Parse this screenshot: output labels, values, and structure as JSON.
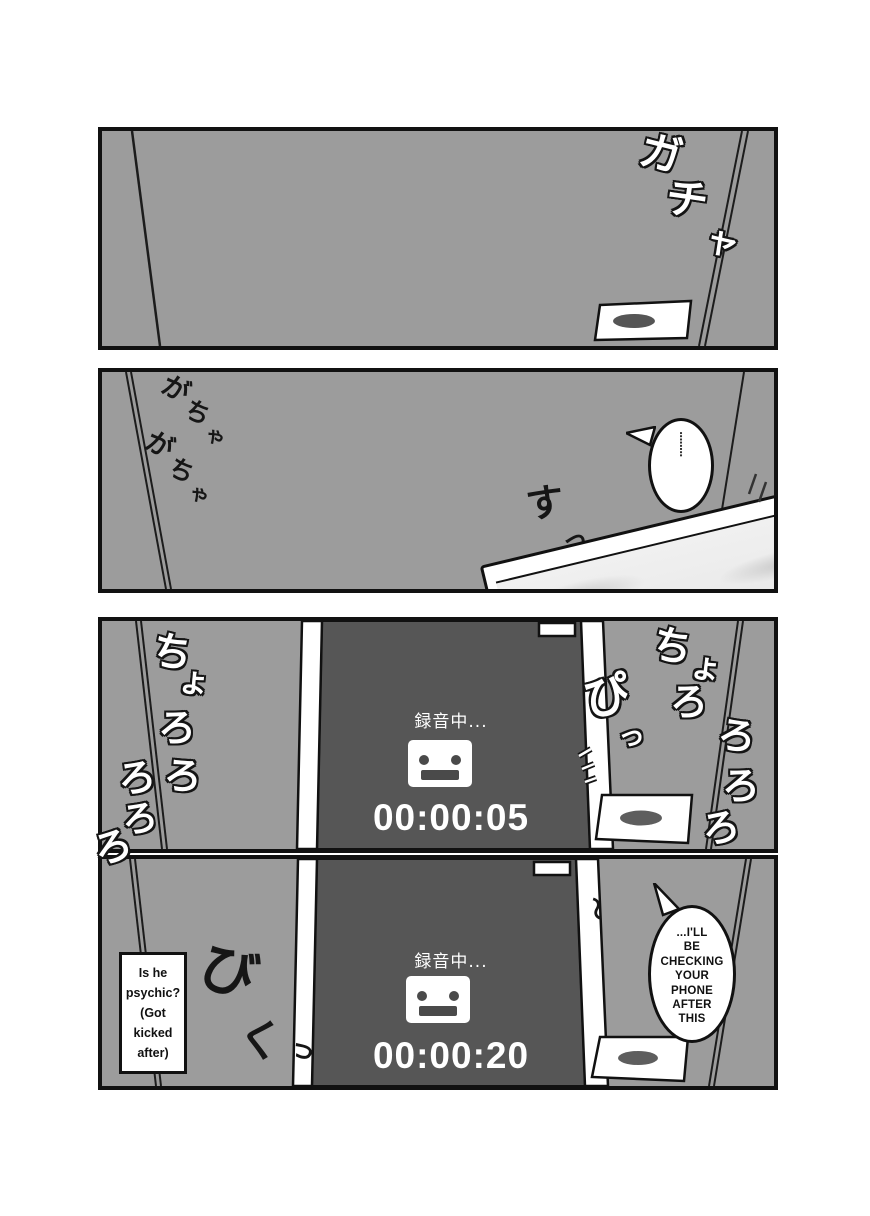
{
  "colors": {
    "wall": "#9c9c9c",
    "panel_border": "#111111",
    "screen": "#565656",
    "ink": "#161616",
    "light_oval": "#5e5e5e",
    "white": "#ffffff"
  },
  "panel1": {
    "sfx_door_open": {
      "chars": [
        "ガ",
        "チ",
        "ャ"
      ]
    }
  },
  "panel2": {
    "sfx_rattle_1": {
      "chars": [
        "が",
        "ち",
        "ゃ"
      ]
    },
    "sfx_rattle_2": {
      "chars": [
        "が",
        "ち",
        "ゃ"
      ]
    },
    "sfx_slide": {
      "chars": [
        "す",
        "っ"
      ]
    },
    "thought_dots": "········"
  },
  "panel3": {
    "recorder": {
      "status": "録音中...",
      "time": "00:00:05"
    },
    "sfx_trickle_left": {
      "chars": [
        "ち",
        "ょ",
        "ろ",
        "ろ",
        "ろ"
      ]
    },
    "sfx_trickle_overflow": {
      "chars": [
        "ろ",
        "ろ"
      ]
    },
    "sfx_beep": {
      "chars": [
        "ぴ",
        "っ"
      ]
    },
    "sfx_trickle_right": {
      "chars": [
        "ち",
        "ょ",
        "ろ",
        "ろ",
        "ろ",
        "ろ"
      ]
    }
  },
  "panel4": {
    "recorder": {
      "status": "録音中...",
      "time": "00:00:20"
    },
    "caption_note": "Is he\npsychic?\n(Got\nkicked\nafter)",
    "speech_bubble": "...I'LL\nBE\nCHECKING\nYOUR\nPHONE\nAFTER\nTHIS",
    "sfx_flinch": {
      "chars": [
        "び",
        "く",
        "っ"
      ]
    },
    "sfx_tremble": "〜"
  }
}
